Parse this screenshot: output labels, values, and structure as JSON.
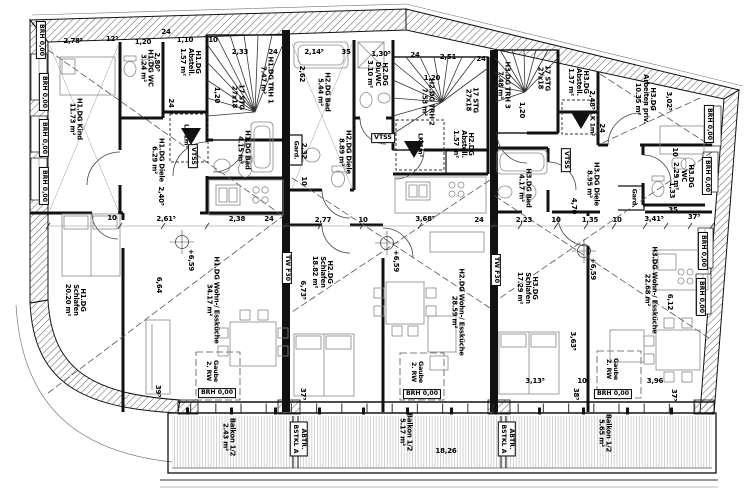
{
  "drawing": {
    "type": "floor-plan",
    "floor": "DG (Dachgeschoss)",
    "colors": {
      "ink": "#111111",
      "hatch": "#666666",
      "furniture": "#888888",
      "balcony_hatch": "#b5b5b5",
      "dashed": "#555555"
    }
  },
  "labels": {
    "room_labels": [
      {
        "n": "room-h1dg-kind",
        "lines": [
          "H1.DG Kind",
          "11.73 m²"
        ],
        "x": 75,
        "y": 119,
        "r": 90
      },
      {
        "n": "room-h1dg-wc",
        "lines": [
          "H1.DG WC",
          "3.24 m²"
        ],
        "x": 146,
        "y": 68,
        "r": 90
      },
      {
        "n": "room-h1dg-abstell",
        "lines": [
          "H1.DG",
          "Abstell.",
          "1.57 m²"
        ],
        "x": 190,
        "y": 62,
        "r": 90
      },
      {
        "n": "room-h1dg-trh1",
        "lines": [
          "H1.DG TRH 1",
          "7.47 m²"
        ],
        "x": 266,
        "y": 80,
        "r": 90
      },
      {
        "n": "room-h1dg-bad",
        "lines": [
          "H1.DG Bad",
          "4.15 m²"
        ],
        "x": 243,
        "y": 150,
        "r": 90
      },
      {
        "n": "room-h1dg-diele",
        "lines": [
          "H1.DG Diele",
          "6.29 m²"
        ],
        "x": 157,
        "y": 160,
        "r": 90
      },
      {
        "n": "room-h1dg-schlafen",
        "lines": [
          "H1.DG",
          "Schlafen",
          "20.20 m²"
        ],
        "x": 75,
        "y": 300,
        "r": 90
      },
      {
        "n": "room-h1dg-wohn",
        "lines": [
          "H1.DG Wohn-/ Essküche",
          "34.17 m²"
        ],
        "x": 212,
        "y": 300,
        "r": 90
      },
      {
        "n": "room-h2dg-bad",
        "lines": [
          "H2.DG Bad",
          "5.44 m²"
        ],
        "x": 323,
        "y": 92,
        "r": 90
      },
      {
        "n": "room-h2dg-duwc",
        "lines": [
          "H2.DG",
          "Du/WC",
          "3.10 m²"
        ],
        "x": 377,
        "y": 74,
        "r": 90
      },
      {
        "n": "room-h2dg-trh2",
        "lines": [
          "H2.DG TRH 2",
          "7.53 m²"
        ],
        "x": 427,
        "y": 102,
        "r": 90
      },
      {
        "n": "room-h2dg-abstell",
        "lines": [
          "H2.DG",
          "Abstell.",
          "1.57 m²"
        ],
        "x": 463,
        "y": 144,
        "r": 90
      },
      {
        "n": "room-h2dg-diele",
        "lines": [
          "H2.DG Diele",
          "8.89 m²"
        ],
        "x": 344,
        "y": 152,
        "r": 90
      },
      {
        "n": "room-h2dg-schlafen",
        "lines": [
          "H2.DG",
          "Schlafen",
          "18.82 m²"
        ],
        "x": 322,
        "y": 272,
        "r": 90
      },
      {
        "n": "room-h2dg-wohn",
        "lines": [
          "H2.DG Wohn-/ Essküche",
          "28.59 m²"
        ],
        "x": 457,
        "y": 312,
        "r": 90
      },
      {
        "n": "room-h3dg-trh3",
        "lines": [
          "H3.DG TRH 3",
          "7.48 m²"
        ],
        "x": 503,
        "y": 85,
        "r": 90
      },
      {
        "n": "room-h3dg-abstell",
        "lines": [
          "H3.DG",
          "Abstell.",
          "1.37 m²"
        ],
        "x": 578,
        "y": 82,
        "r": 90
      },
      {
        "n": "room-h3dg-arbeiten",
        "lines": [
          "H3.DG",
          "Arbeiten priv.",
          "10.35 m²"
        ],
        "x": 645,
        "y": 99,
        "r": 90
      },
      {
        "n": "room-h3dg-bad",
        "lines": [
          "H3.DG Bad",
          "4.17 m²"
        ],
        "x": 524,
        "y": 188,
        "r": 90
      },
      {
        "n": "room-h3dg-diele",
        "lines": [
          "H3.DG Diele",
          "8.95 m²"
        ],
        "x": 592,
        "y": 184,
        "r": 90
      },
      {
        "n": "room-h3dg-wc",
        "lines": [
          "H3.DG",
          "WC",
          "2.29 m²"
        ],
        "x": 683,
        "y": 176,
        "r": 90
      },
      {
        "n": "room-h3dg-schlafen",
        "lines": [
          "H3.DG",
          "Schlafen",
          "17.29 m²"
        ],
        "x": 527,
        "y": 288,
        "r": 90
      },
      {
        "n": "room-h3dg-wohn",
        "lines": [
          "H3.DG Wohn-/ Essküche",
          "22.68 m²"
        ],
        "x": 650,
        "y": 290,
        "r": 90
      },
      {
        "n": "room-balkon-1",
        "lines": [
          "Balkon 1/2",
          "2.43 m²"
        ],
        "x": 228,
        "y": 437,
        "r": 90
      },
      {
        "n": "room-balkon-2",
        "lines": [
          "Balkon 1/2",
          "5.17 m²"
        ],
        "x": 405,
        "y": 432,
        "r": 90
      },
      {
        "n": "room-balkon-3",
        "lines": [
          "Balkon 1/2",
          "5.65 m²"
        ],
        "x": 604,
        "y": 433,
        "r": 90
      }
    ],
    "stair_labels": [
      {
        "n": "stair-steps-trh1",
        "lines": [
          "17 STG",
          "27x18"
        ],
        "x": 237,
        "y": 97,
        "r": 90
      },
      {
        "n": "stair-steps-trh2",
        "lines": [
          "17 STG",
          "27x18"
        ],
        "x": 471,
        "y": 100,
        "r": 90
      },
      {
        "n": "stair-steps-trh3",
        "lines": [
          "17 STG",
          "27x18"
        ],
        "x": 543,
        "y": 78,
        "r": 90
      }
    ],
    "box_labels": [
      {
        "n": "vtss-h1",
        "lines": [
          "VTSS"
        ],
        "x": 193,
        "y": 156,
        "r": 90
      },
      {
        "n": "vtss-h2",
        "lines": [
          "VTSS"
        ],
        "x": 383,
        "y": 138,
        "r": 0
      },
      {
        "n": "vtss-h3",
        "lines": [
          "VTSS"
        ],
        "x": 566,
        "y": 160,
        "r": 90
      },
      {
        "n": "tw-f30-left",
        "lines": [
          "TW F30"
        ],
        "x": 287,
        "y": 268,
        "r": 90
      },
      {
        "n": "tw-f30-right",
        "lines": [
          "TW F30"
        ],
        "x": 496,
        "y": 270,
        "r": 90
      },
      {
        "n": "abtr-bstkl-1",
        "lines": [
          "ABTR.",
          "BSTKL A"
        ],
        "x": 299,
        "y": 439,
        "r": 90
      },
      {
        "n": "abtr-bstkl-2",
        "lines": [
          "ABTR.",
          "BSTKL A"
        ],
        "x": 507,
        "y": 439,
        "r": 90
      },
      {
        "n": "brh-bottom-1",
        "lines": [
          "BRH  0,00"
        ],
        "x": 217,
        "y": 393,
        "r": 0
      },
      {
        "n": "brh-bottom-2",
        "lines": [
          "BRH  0,00"
        ],
        "x": 422,
        "y": 394,
        "r": 0
      },
      {
        "n": "brh-bottom-3",
        "lines": [
          "BRH  0,00"
        ],
        "x": 613,
        "y": 394,
        "r": 0
      },
      {
        "n": "brh-left-1",
        "lines": [
          "BRH  0,00"
        ],
        "x": 41,
        "y": 40,
        "r": 90
      },
      {
        "n": "brh-left-2",
        "lines": [
          "BRH  0,00"
        ],
        "x": 44,
        "y": 92,
        "r": 90
      },
      {
        "n": "brh-left-3",
        "lines": [
          "BRH  0,00"
        ],
        "x": 44,
        "y": 138,
        "r": 90
      },
      {
        "n": "brh-left-4",
        "lines": [
          "BRH  0,00"
        ],
        "x": 44,
        "y": 186,
        "r": 90
      },
      {
        "n": "brh-right-1",
        "lines": [
          "BRH  0,00"
        ],
        "x": 709,
        "y": 124,
        "r": 90
      },
      {
        "n": "brh-right-2",
        "lines": [
          "BRH  0,00"
        ],
        "x": 707,
        "y": 176,
        "r": 90
      },
      {
        "n": "brh-right-3",
        "lines": [
          "BRH  0,00"
        ],
        "x": 703,
        "y": 251,
        "r": 90
      },
      {
        "n": "brh-right-4",
        "lines": [
          "BRH  0,00"
        ],
        "x": 701,
        "y": 297,
        "r": 90
      }
    ],
    "note_labels": [
      {
        "n": "lk-h1",
        "lines": [
          "LK 1m²"
        ],
        "x": 186,
        "y": 136,
        "r": 90
      },
      {
        "n": "lk-h2",
        "lines": [
          "LK 1m²"
        ],
        "x": 420,
        "y": 145,
        "r": 90
      },
      {
        "n": "lk-h3",
        "lines": [
          "LK 1m²"
        ],
        "x": 592,
        "y": 124,
        "r": 90
      },
      {
        "n": "gard-h2",
        "lines": [
          "Gard."
        ],
        "x": 296,
        "y": 150,
        "r": 90
      },
      {
        "n": "gard-h3",
        "lines": [
          "Gard."
        ],
        "x": 634,
        "y": 198,
        "r": 90
      },
      {
        "n": "gaube-h1",
        "lines": [
          "Gaube",
          "2. RW"
        ],
        "x": 212,
        "y": 371,
        "r": 90
      },
      {
        "n": "gaube-h2",
        "lines": [
          "Gaube",
          "2. RW"
        ],
        "x": 417,
        "y": 372,
        "r": 90
      },
      {
        "n": "gaube-h3",
        "lines": [
          "Gaube",
          "2. RW"
        ],
        "x": 612,
        "y": 369,
        "r": 90
      }
    ],
    "dim_labels": [
      {
        "t": "2,78⁵",
        "x": 73,
        "y": 42,
        "r": 0
      },
      {
        "t": "12⁵",
        "x": 112,
        "y": 40,
        "r": 0
      },
      {
        "t": "1,20",
        "x": 143,
        "y": 43,
        "r": 0
      },
      {
        "t": "24",
        "x": 166,
        "y": 33,
        "r": 0
      },
      {
        "t": "1,10",
        "x": 185,
        "y": 41,
        "r": 0
      },
      {
        "t": "10",
        "x": 213,
        "y": 41,
        "r": 0
      },
      {
        "t": "2,33",
        "x": 240,
        "y": 53,
        "r": 0
      },
      {
        "t": "24",
        "x": 273,
        "y": 53,
        "r": 0
      },
      {
        "t": "2,14⁵",
        "x": 314,
        "y": 53,
        "r": 0
      },
      {
        "t": "35",
        "x": 346,
        "y": 53,
        "r": 0
      },
      {
        "t": "1,30⁵",
        "x": 381,
        "y": 55,
        "r": 0
      },
      {
        "t": "24",
        "x": 415,
        "y": 56,
        "r": 0
      },
      {
        "t": "2,51",
        "x": 448,
        "y": 58,
        "r": 0
      },
      {
        "t": "24",
        "x": 481,
        "y": 60,
        "r": 0
      },
      {
        "t": "1,20",
        "x": 432,
        "y": 79,
        "r": 0
      },
      {
        "t": "2,80⁵",
        "x": 156,
        "y": 62,
        "r": 90
      },
      {
        "t": "1,20",
        "x": 216,
        "y": 95,
        "r": 90
      },
      {
        "t": "24",
        "x": 170,
        "y": 103,
        "r": 90
      },
      {
        "t": "2,40⁵",
        "x": 160,
        "y": 196,
        "r": 90
      },
      {
        "t": "2,62",
        "x": 301,
        "y": 74,
        "r": 90
      },
      {
        "t": "2,32",
        "x": 303,
        "y": 151,
        "r": 90
      },
      {
        "t": "10",
        "x": 303,
        "y": 181,
        "r": 90
      },
      {
        "t": "1,20",
        "x": 521,
        "y": 110,
        "r": 90
      },
      {
        "t": "2,48⁵",
        "x": 591,
        "y": 100,
        "r": 90
      },
      {
        "t": "24",
        "x": 601,
        "y": 128,
        "r": 90
      },
      {
        "t": "3,02⁵",
        "x": 668,
        "y": 101,
        "r": 90
      },
      {
        "t": "10",
        "x": 674,
        "y": 152,
        "r": 90
      },
      {
        "t": "1,33",
        "x": 671,
        "y": 190,
        "r": 90
      },
      {
        "t": "10",
        "x": 112,
        "y": 219,
        "r": 0
      },
      {
        "t": "2,61⁵",
        "x": 166,
        "y": 220,
        "r": 0
      },
      {
        "t": "2,38",
        "x": 237,
        "y": 220,
        "r": 0
      },
      {
        "t": "24",
        "x": 269,
        "y": 220,
        "r": 0
      },
      {
        "t": "2,77",
        "x": 323,
        "y": 221,
        "r": 0
      },
      {
        "t": "10",
        "x": 363,
        "y": 221,
        "r": 0
      },
      {
        "t": "3,68⁵",
        "x": 425,
        "y": 220,
        "r": 0
      },
      {
        "t": "24",
        "x": 479,
        "y": 221,
        "r": 0
      },
      {
        "t": "2,23",
        "x": 524,
        "y": 221,
        "r": 0
      },
      {
        "t": "10",
        "x": 556,
        "y": 221,
        "r": 0
      },
      {
        "t": "1,35",
        "x": 590,
        "y": 221,
        "r": 0
      },
      {
        "t": "10",
        "x": 617,
        "y": 221,
        "r": 0
      },
      {
        "t": "3,41⁵",
        "x": 654,
        "y": 220,
        "r": 0
      },
      {
        "t": "35",
        "x": 673,
        "y": 211,
        "r": 0
      },
      {
        "t": "37⁵",
        "x": 694,
        "y": 218,
        "r": 0
      },
      {
        "t": "4,70",
        "x": 573,
        "y": 206,
        "r": 90
      },
      {
        "t": "6,64",
        "x": 158,
        "y": 285,
        "r": 90
      },
      {
        "t": "6,73⁵",
        "x": 302,
        "y": 290,
        "r": 90
      },
      {
        "t": "6,12",
        "x": 669,
        "y": 302,
        "r": 90
      },
      {
        "t": "+6,59",
        "x": 190,
        "y": 260,
        "r": 90
      },
      {
        "t": "+6,59",
        "x": 395,
        "y": 261,
        "r": 90
      },
      {
        "t": "+6,59",
        "x": 592,
        "y": 269,
        "r": 90
      },
      {
        "t": "3,63⁵",
        "x": 572,
        "y": 341,
        "r": 90
      },
      {
        "t": "3,13⁵",
        "x": 535,
        "y": 382,
        "r": 0
      },
      {
        "t": "10",
        "x": 582,
        "y": 382,
        "r": 0
      },
      {
        "t": "3,96",
        "x": 655,
        "y": 382,
        "r": 0
      },
      {
        "t": "38⁵",
        "x": 575,
        "y": 394,
        "r": 90
      },
      {
        "t": "37⁵",
        "x": 673,
        "y": 395,
        "r": 90
      },
      {
        "t": "39⁵",
        "x": 157,
        "y": 391,
        "r": 90
      },
      {
        "t": "37⁵",
        "x": 302,
        "y": 394,
        "r": 90
      },
      {
        "t": "18,26",
        "x": 446,
        "y": 452,
        "r": 0
      }
    ]
  }
}
